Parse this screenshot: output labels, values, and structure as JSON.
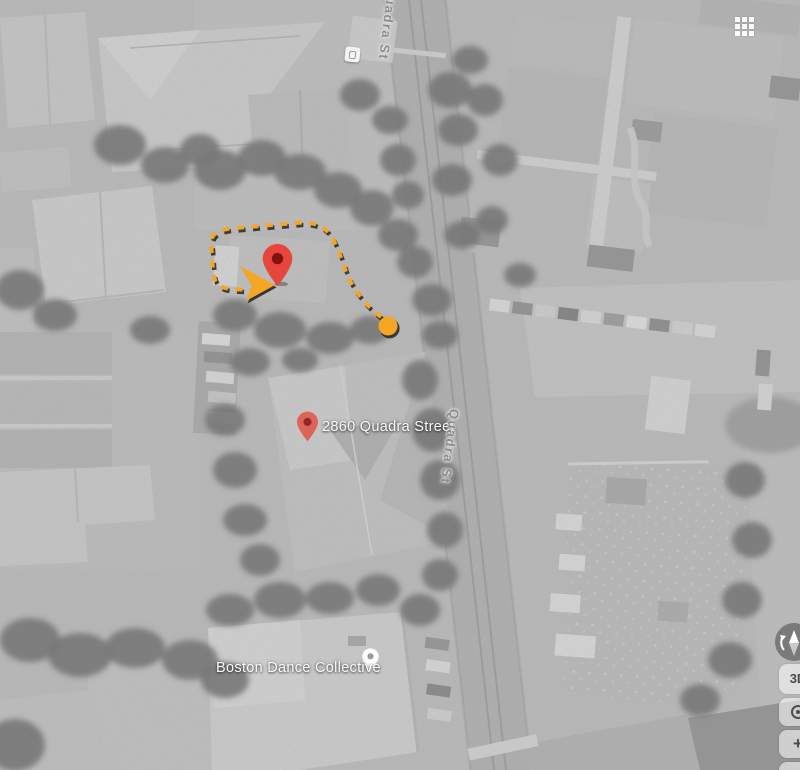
{
  "map": {
    "imagery": "grayscale-satellite",
    "street_label_top": "Quadra St",
    "street_label_mid": "Quadra St",
    "address_label": "2860 Quadra Street",
    "poi_label": "Boston Dance Collective"
  },
  "route": {
    "style": "dashed",
    "color": "#F5A623",
    "shadow_color": "#1D1D1D",
    "start_marker": "filled-orange-circle",
    "end_marker": "red-pin",
    "position_indicator": "orange-arrow"
  },
  "markers": {
    "destination_pin_color": "#E8463C",
    "destination_pin_center_color": "#7E150D",
    "address_pin_color": "#E0635A",
    "poi_pin_color": "#FDFDFD",
    "bus_stop_icon": "bus-stop"
  },
  "controls": {
    "apps_grid_icon": "apps-grid",
    "compass_icon": "compass",
    "three_d_label": "3D",
    "my_location_icon": "my-location",
    "zoom_in_label": "+",
    "zoom_out_label": "−"
  }
}
